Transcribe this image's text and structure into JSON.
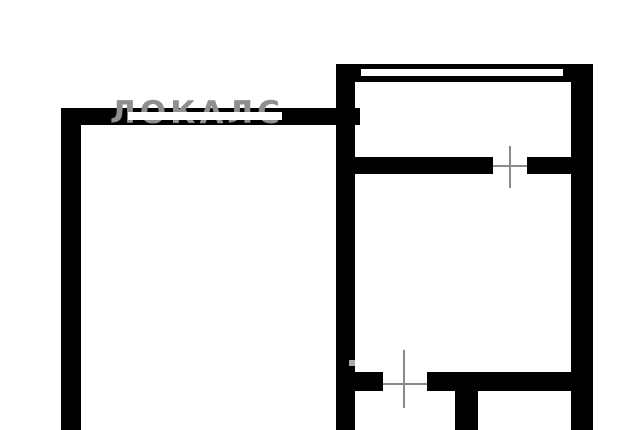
{
  "watermark": {
    "text": "ЛОКАЛС",
    "color": "#8f8f8f"
  },
  "colors": {
    "background": "#ffffff",
    "wall": "#000000",
    "window": "#ffffff",
    "door_axis": "#8a8a8a",
    "mark": "#a9a9a9",
    "strike": "#ffffff"
  },
  "floorplan": {
    "walls": [
      {
        "name": "left-outer-wall",
        "x": 61,
        "y": 108,
        "w": 20,
        "h": 322
      },
      {
        "name": "left-room-top-wall",
        "x": 61,
        "y": 108,
        "w": 299,
        "h": 17
      },
      {
        "name": "right-section-left-wall",
        "x": 336,
        "y": 64,
        "w": 19,
        "h": 366
      },
      {
        "name": "right-section-top-wall",
        "x": 336,
        "y": 64,
        "w": 257,
        "h": 18
      },
      {
        "name": "right-outer-wall",
        "x": 571,
        "y": 64,
        "w": 22,
        "h": 366
      },
      {
        "name": "upper-divider-left",
        "x": 355,
        "y": 157,
        "w": 138,
        "h": 17
      },
      {
        "name": "upper-divider-right",
        "x": 527,
        "y": 157,
        "w": 44,
        "h": 17
      },
      {
        "name": "lower-divider-left",
        "x": 355,
        "y": 372,
        "w": 28,
        "h": 19
      },
      {
        "name": "lower-divider-right",
        "x": 427,
        "y": 372,
        "w": 144,
        "h": 19
      },
      {
        "name": "bottom-stub-wall",
        "x": 455,
        "y": 390,
        "w": 23,
        "h": 40
      }
    ],
    "windows": [
      {
        "name": "window-slot",
        "x": 361,
        "y": 69,
        "w": 202,
        "h": 7
      }
    ],
    "door_axes": [
      {
        "name": "upper-door-axis-vertical",
        "x": 509,
        "y": 146,
        "w": 2,
        "h": 42
      },
      {
        "name": "upper-door-axis-horizontal",
        "x": 493,
        "y": 165,
        "w": 34,
        "h": 2
      },
      {
        "name": "lower-door-axis-vertical",
        "x": 403,
        "y": 350,
        "w": 2,
        "h": 58
      },
      {
        "name": "lower-door-axis-horizontal",
        "x": 382,
        "y": 383,
        "w": 45,
        "h": 2
      }
    ],
    "marks": [
      {
        "name": "gray-speck",
        "x": 349,
        "y": 360,
        "w": 6,
        "h": 6
      }
    ],
    "strike_band": {
      "name": "watermark-strike-band",
      "x": 128,
      "y": 112,
      "w": 154,
      "h": 8
    }
  }
}
